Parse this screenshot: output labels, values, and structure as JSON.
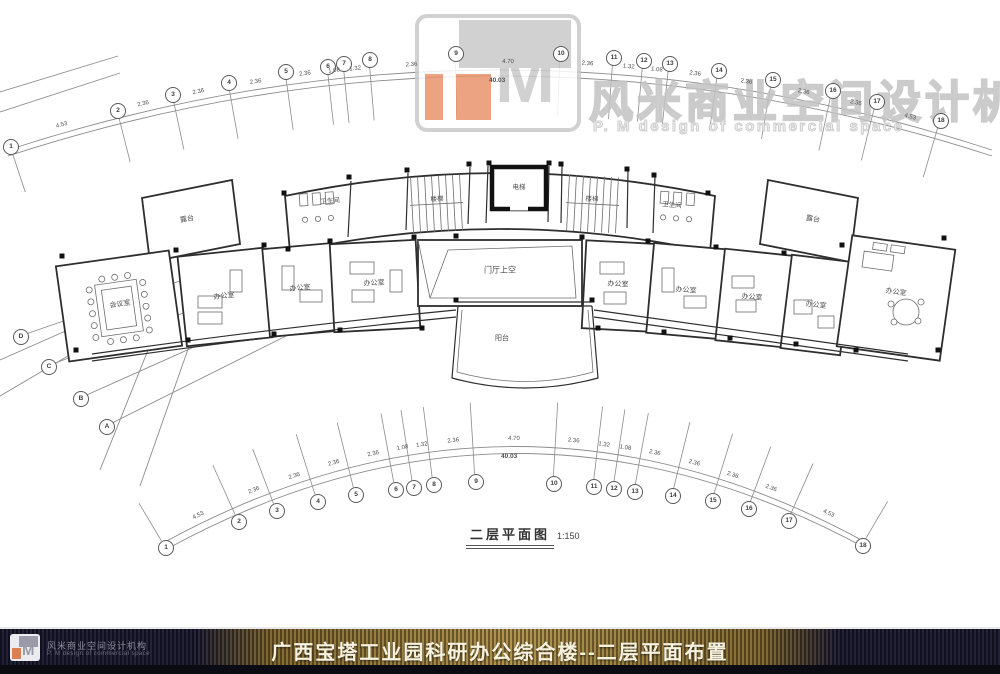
{
  "watermark": {
    "logo_letter": "M",
    "brand_cn": "风米商业空间设计机构",
    "brand_en": "P. M design of commercial space",
    "accent_color": "#e8946c",
    "gray_color": "#c9c9c9"
  },
  "plan": {
    "drawing_title": "二层平面图",
    "drawing_scale": "1:150",
    "grid": {
      "top_bubbles": [
        "1",
        "2",
        "3",
        "4",
        "5",
        "6",
        "7",
        "8",
        "9",
        "10",
        "11",
        "12",
        "13",
        "14",
        "15",
        "16",
        "17",
        "18"
      ],
      "bottom_bubbles": [
        "1",
        "2",
        "3",
        "4",
        "5",
        "6",
        "7",
        "8",
        "9",
        "10",
        "11",
        "12",
        "13",
        "14",
        "15",
        "16",
        "17",
        "18"
      ],
      "left_bubbles": [
        "D",
        "C",
        "B",
        "A"
      ],
      "top_dims": [
        "4.53",
        "2.36",
        "2.36",
        "2.36",
        "2.36",
        "1.08",
        "1.32",
        "2.36",
        "4.70",
        "2.36",
        "1.32",
        "1.08",
        "2.36",
        "2.36",
        "2.36",
        "2.36",
        "4.53"
      ],
      "bottom_dims": [
        "4.53",
        "2.36",
        "2.36",
        "2.36",
        "2.36",
        "1.08",
        "1.32",
        "2.36",
        "4.70",
        "2.36",
        "1.32",
        "1.08",
        "2.36",
        "2.36",
        "2.36",
        "2.36",
        "4.53"
      ],
      "top_total": "40.03",
      "bottom_total": "40.03"
    },
    "room_labels": [
      "露台",
      "卫生间",
      "楼梯",
      "电梯",
      "楼梯",
      "卫生间",
      "露台",
      "会议室",
      "办公室",
      "办公室",
      "办公室",
      "门厅上空",
      "办公室",
      "办公室",
      "办公室",
      "办公室",
      "办公室",
      "阳台"
    ]
  },
  "footer": {
    "title": "广西宝塔工业园科研办公综合楼--二层平面布置",
    "brand_cn": "风米商业空间设计机构",
    "brand_en": "P. M design of commercial space",
    "gold_color": "#c7a246",
    "bar_color": "#17172a"
  }
}
